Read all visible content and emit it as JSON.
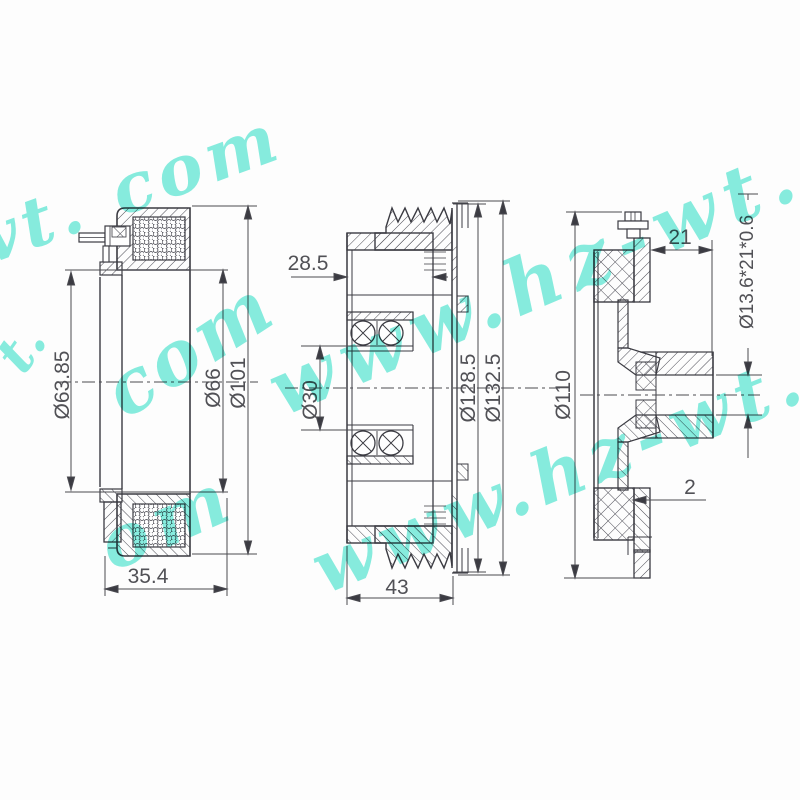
{
  "meta": {
    "background": "#ffffff",
    "line_color": "#3b3b42",
    "dim_color": "#4a4a50",
    "text_color": "#515156",
    "watermark_color": "#6ce9d8"
  },
  "watermark": {
    "text": "www.hz-wt.com",
    "fragments": [
      {
        "text": "wt. com"
      },
      {
        "text": "com"
      },
      {
        "text": "www.hz-wt."
      },
      {
        "text": "www.hz-wt."
      },
      {
        "text": "om"
      },
      {
        "text": "t."
      }
    ]
  },
  "views": {
    "coil": {
      "name": "clutch-coil-section",
      "dims": {
        "bore": "Ø63.85",
        "seat": "Ø66",
        "outer": "Ø101",
        "width": "35.4"
      }
    },
    "pulley": {
      "name": "pulley-bearing-section",
      "dims": {
        "hub_width": "28.5",
        "bearing_bore": "Ø30",
        "groove_od": "Ø128.5",
        "outer_od": "Ø132.5",
        "width": "43"
      }
    },
    "hub": {
      "name": "clutch-hub-section",
      "dims": {
        "outer": "Ø110",
        "boss_length": "21",
        "spline": "Ø13.6*21*0.6",
        "step": "2"
      }
    }
  }
}
